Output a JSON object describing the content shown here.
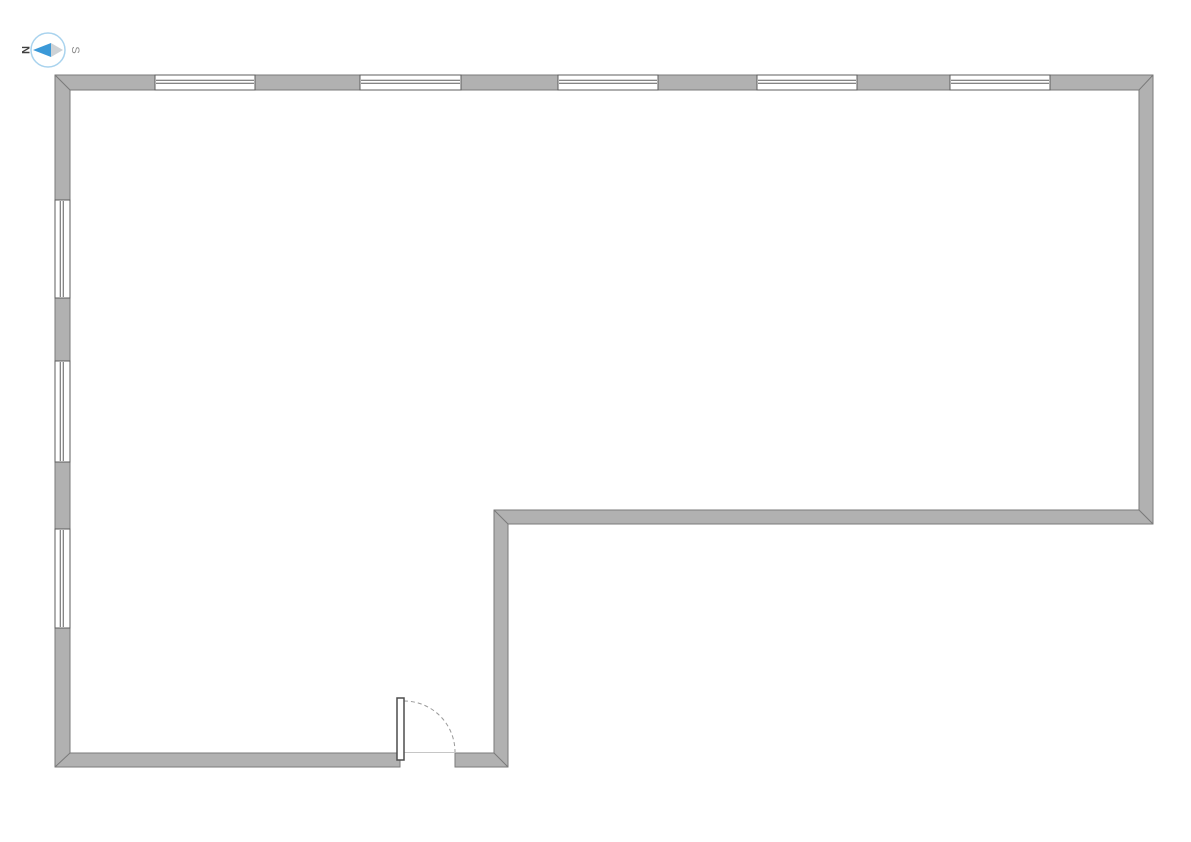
{
  "page": {
    "background_color": "#ffffff"
  },
  "compass": {
    "north_label": "N",
    "south_label": "S",
    "cx": 48,
    "cy": 50,
    "r": 17,
    "ring_color": "#a9d3ee",
    "needle_north_color": "#3b99d8",
    "needle_south_color": "#cdd2d6",
    "needle": {
      "tip_west_x": 33,
      "tip_east_x": 63,
      "waist_x": 51,
      "half_height": 7,
      "cy": 50
    }
  },
  "floor_plan": {
    "wall": {
      "fill": "#b1b1b1",
      "outline": "#7a7a7a",
      "thickness": 15,
      "polygon_points": "400,767 55,767 55,75 1153,75 1153,524 508,524 508,767 455,767 455,753 494,753 494,510 1139,510 1139,90 70,90 70,753 400,753",
      "miter_joints": [
        [
          55,
          75,
          70,
          90
        ],
        [
          1139,
          90,
          1153,
          75
        ],
        [
          1139,
          510,
          1153,
          524
        ],
        [
          494,
          510,
          508,
          524
        ],
        [
          70,
          753,
          55,
          767
        ],
        [
          494,
          753,
          508,
          767
        ]
      ]
    },
    "windows": {
      "fill": "#ffffff",
      "frame_color": "#5d5d5d",
      "glazing_fractions": [
        0.35,
        0.55
      ],
      "items": [
        {
          "id": "north-1",
          "orientation": "h",
          "x": 155,
          "y": 75,
          "w": 100,
          "h": 15
        },
        {
          "id": "north-2",
          "orientation": "h",
          "x": 360,
          "y": 75,
          "w": 101,
          "h": 15
        },
        {
          "id": "north-3",
          "orientation": "h",
          "x": 558,
          "y": 75,
          "w": 100,
          "h": 15
        },
        {
          "id": "north-4",
          "orientation": "h",
          "x": 757,
          "y": 75,
          "w": 100,
          "h": 15
        },
        {
          "id": "north-5",
          "orientation": "h",
          "x": 950,
          "y": 75,
          "w": 100,
          "h": 15
        },
        {
          "id": "west-1",
          "orientation": "v",
          "x": 55,
          "y": 200,
          "w": 15,
          "h": 98
        },
        {
          "id": "west-2",
          "orientation": "v",
          "x": 55,
          "y": 361,
          "w": 15,
          "h": 101
        },
        {
          "id": "west-3",
          "orientation": "v",
          "x": 55,
          "y": 529,
          "w": 15,
          "h": 99
        }
      ]
    },
    "door": {
      "leaf": {
        "x": 397,
        "y": 698,
        "w": 7,
        "h": 62
      },
      "leaf_fill": "#ffffff",
      "leaf_outline": "#4d4d4d",
      "hinge": {
        "x": 404,
        "y": 752
      },
      "swing_radius": 51,
      "arc_color": "#9a9a9a",
      "arc_dash": "4 3",
      "threshold": {
        "x1": 400,
        "y1": 752.5,
        "x2": 455,
        "y2": 752.5
      },
      "threshold_color": "#c6c6c6"
    }
  }
}
